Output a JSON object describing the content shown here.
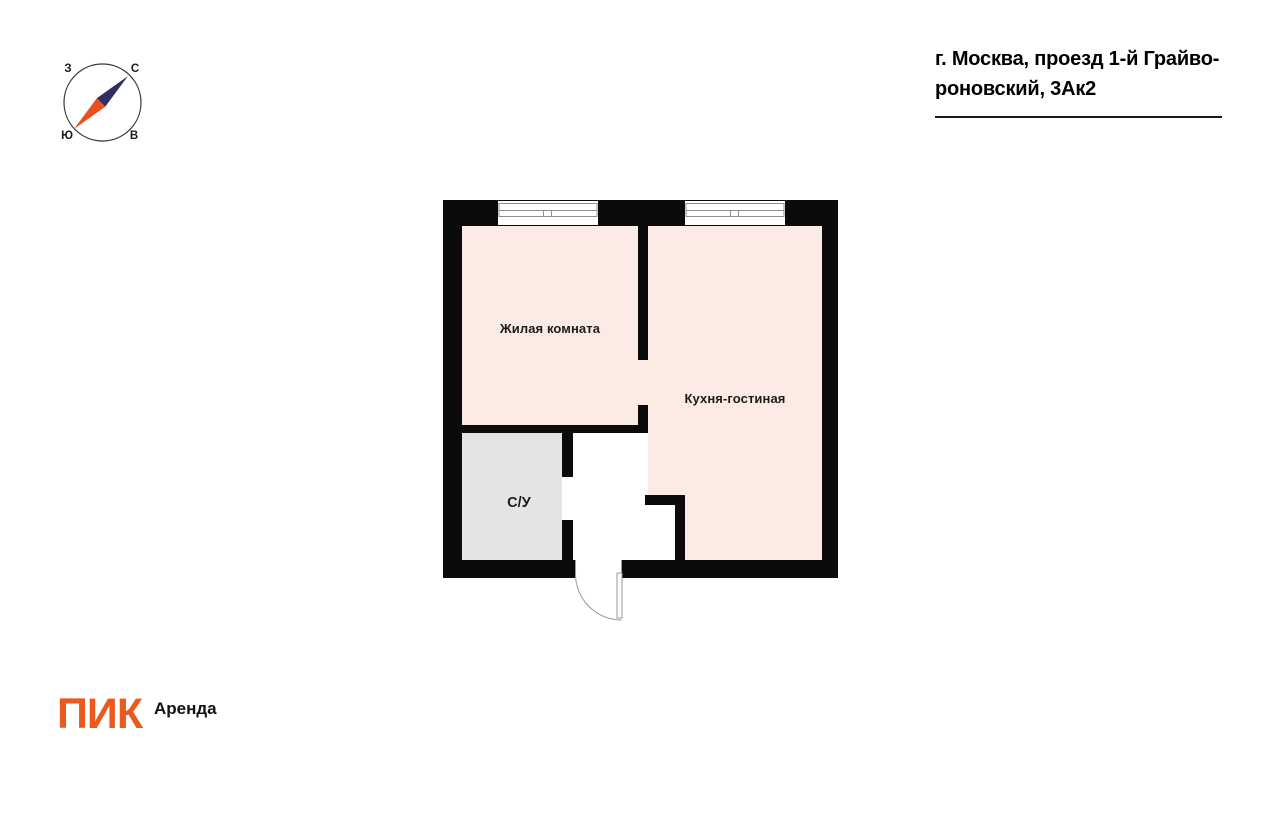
{
  "header": {
    "address_line_1": "г. Москва, проезд 1-й Грайво-",
    "address_line_2": "роновский, 3Ак2"
  },
  "compass": {
    "north": "С",
    "south": "Ю",
    "west": "З",
    "east": "В",
    "north_needle_color": "#2d3060",
    "south_needle_color": "#e8511d"
  },
  "floor_plan": {
    "wall_color": "#0b0b0b",
    "rooms": [
      {
        "label": "Жилая комната",
        "fill": "#fceae5"
      },
      {
        "label": "Кухня-гостиная",
        "fill": "#fceae5"
      },
      {
        "label": "С/У",
        "fill": "#e4e4e4"
      }
    ]
  },
  "footer": {
    "logo": "ПИК",
    "logo_color": "#ea5a1e",
    "suffix": "Аренда"
  }
}
